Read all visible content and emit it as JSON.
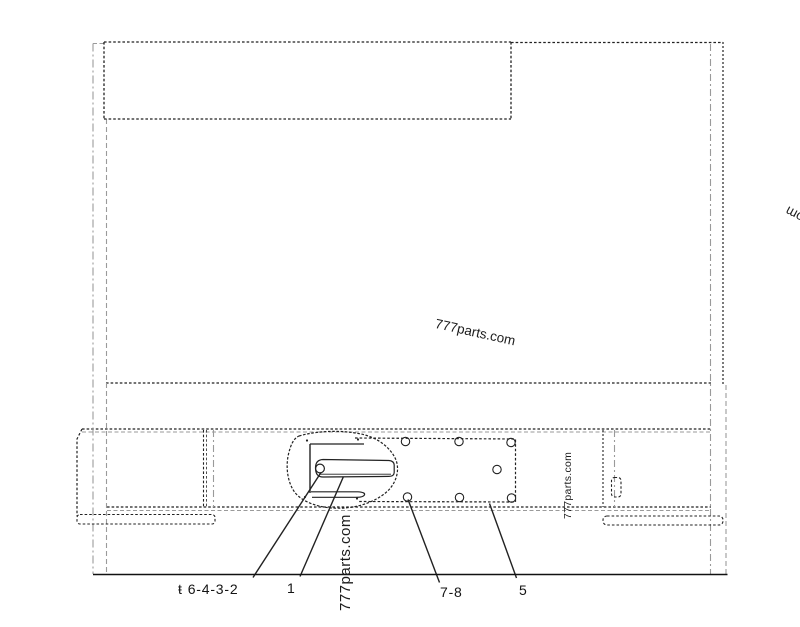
{
  "page": {
    "background": "#ffffff"
  },
  "diagram": {
    "type": "technical-parts-line-drawing",
    "line_color": "#222222",
    "light_line_color": "#9a9a9a",
    "baseline_color": "#111111"
  },
  "watermarks": {
    "center": "777parts.com",
    "right_vertical": "777parts.com",
    "bottom_vertical": "777parts.com",
    "edge_fragment": "777parts.com"
  },
  "callouts": [
    {
      "prefix": "ŧ",
      "text": "6-4-3-2"
    },
    {
      "text": "1"
    },
    {
      "text": "7-8"
    },
    {
      "text": "5"
    }
  ]
}
